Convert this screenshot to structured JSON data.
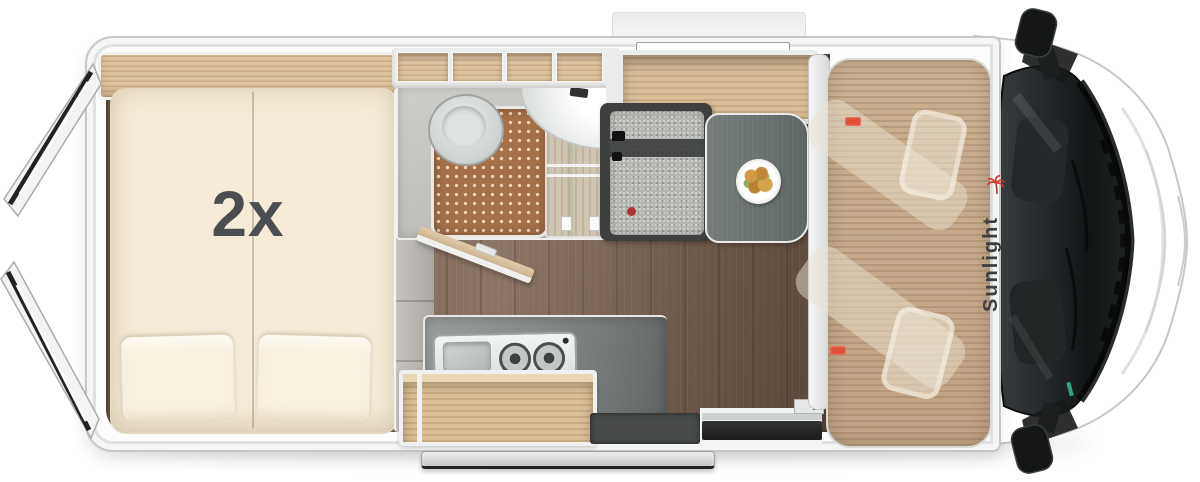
{
  "scene": {
    "description": "Top-down 3D floorplan rendering of a camper van",
    "brand": "Sunlight",
    "bed_label": "2x"
  },
  "colors": {
    "body_white": "#fdfdfd",
    "body_outline": "#c6c8c8",
    "floor_wood": "#7c6656",
    "cab_panel_wood": "#c5ab8c",
    "furniture_wood": "#dcc49e",
    "mattress_cream": "#f5ebd8",
    "counter_gray": "#868a89",
    "bench_upholstery": "#b4b7b1",
    "bench_frame": "#3d403f",
    "table_top": "#6b7172",
    "shower_mat": "#a56f48",
    "windshield_glass": "#1c2022",
    "accent_red": "#e04f35",
    "logo_red": "#d5372b",
    "logo_gray": "#3d3e3e"
  },
  "elements": [
    "rear-doors-open",
    "double-bed",
    "headboard-shelf",
    "overhead-lockers",
    "toilet",
    "shower-tray",
    "washbasin",
    "wardrobe",
    "bathroom-door-open",
    "kitchen-counter",
    "stove-sink-combo",
    "open-shelf",
    "dinette-bench",
    "dinette-table",
    "food-plate",
    "cab-swivel-seats",
    "windshield",
    "side-mirrors",
    "entry-step",
    "exterior-step",
    "top-window",
    "roof-awning"
  ]
}
